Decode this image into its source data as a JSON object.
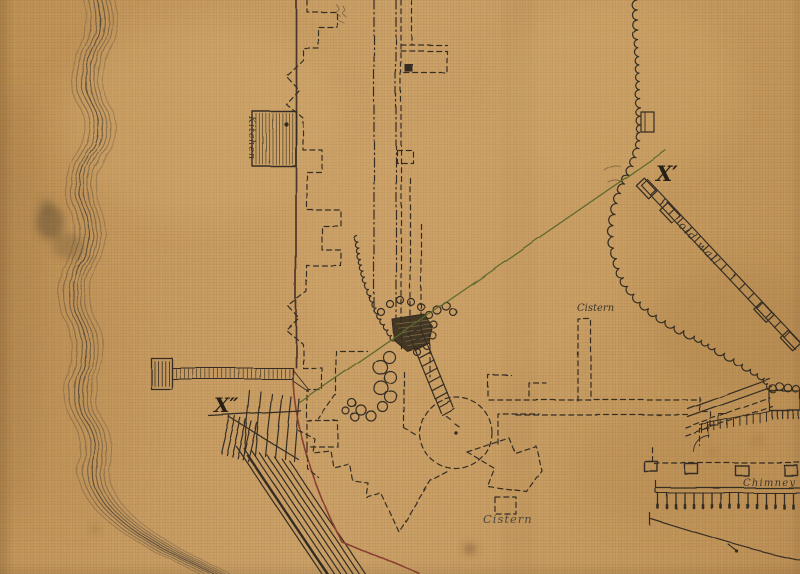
{
  "map": {
    "labels": {
      "kitchen": "Kitchen",
      "x_prime": "X′",
      "x_double_prime": "X″",
      "old_wall": "old wall",
      "cistern_upper": "Cistern",
      "cistern_lower": "Cistern",
      "chimney": "Chimney"
    },
    "colors": {
      "fabric_base": "#c89a60",
      "ink": "#332c21",
      "wall_red": "#8a3c30",
      "fort_outline_red": "#7a3a2c",
      "survey_green": "#5a672a",
      "pencil": "#4c463c"
    }
  }
}
